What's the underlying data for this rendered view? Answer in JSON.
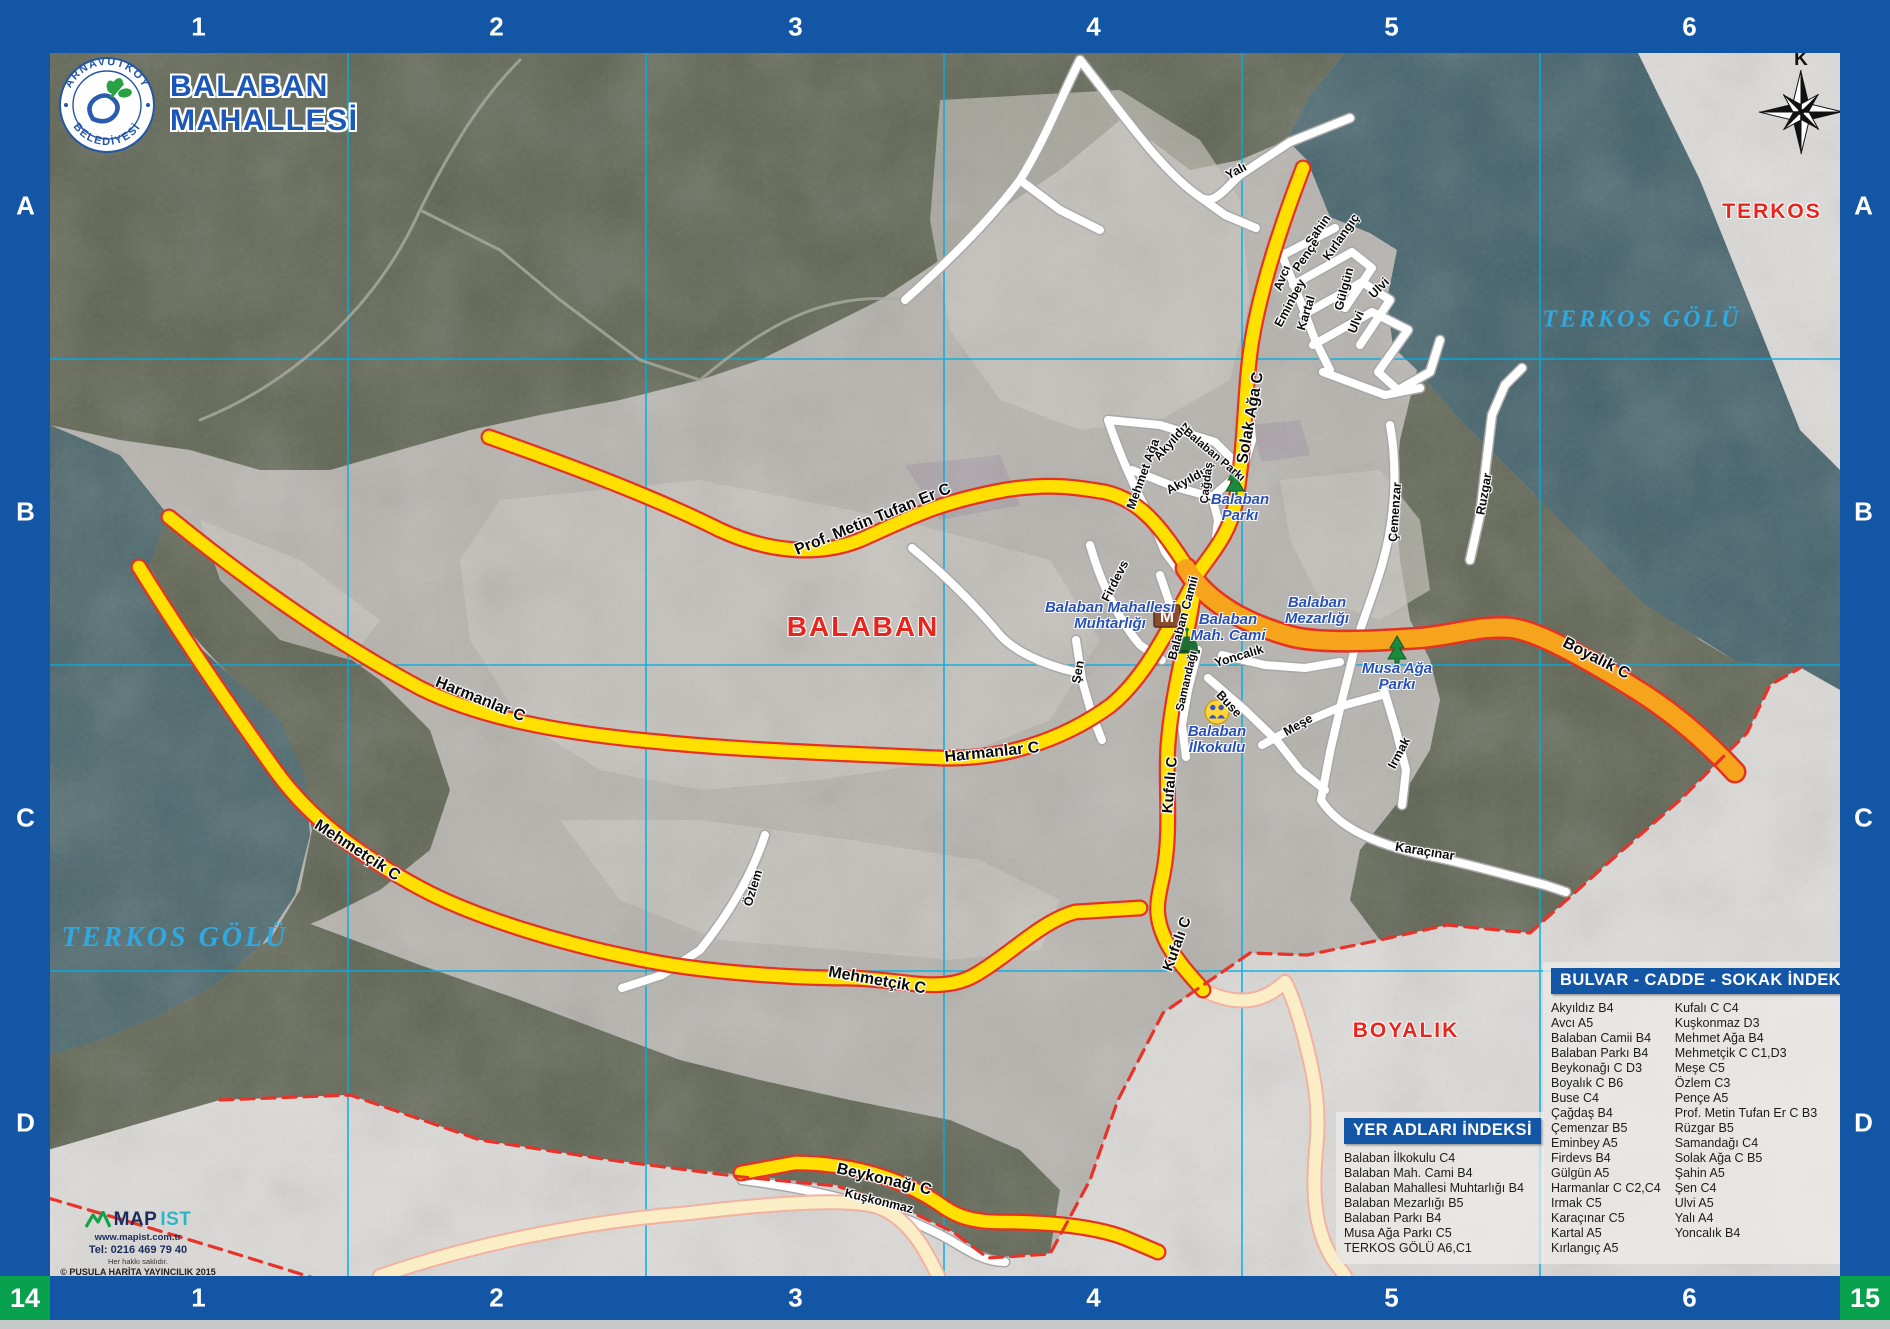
{
  "sheet": {
    "title_line1": "BALABAN",
    "title_line2": "MAHALLESİ",
    "logo_top": "ARNAVUTKÖY",
    "logo_bottom": "BELEDİYESİ",
    "compass_letter": "K"
  },
  "grid": {
    "columns": [
      "1",
      "2",
      "3",
      "4",
      "5",
      "6"
    ],
    "rows": [
      "A",
      "B",
      "C",
      "D"
    ],
    "corner_bottom_left": "14",
    "corner_bottom_right": "15"
  },
  "map": {
    "icons": {
      "muhtarlik_letter": "M"
    },
    "area_labels": [
      {
        "t": "BALABAN",
        "x": 863,
        "y": 627,
        "cls": "al-red",
        "s": 28
      },
      {
        "t": "TERKOS",
        "x": 1772,
        "y": 212,
        "cls": "al-red",
        "s": 21
      },
      {
        "t": "BOYALIK",
        "x": 1406,
        "y": 1031,
        "cls": "al-red",
        "s": 21
      },
      {
        "t": "TERKOS GÖLÜ",
        "x": 175,
        "y": 938,
        "cls": "al-lake",
        "s": 28
      },
      {
        "t": "TERKOS GÖLÜ",
        "x": 1642,
        "y": 320,
        "cls": "al-lake",
        "s": 24
      }
    ],
    "street_labels": [
      {
        "t": "Prof. Metin Tufan Er C",
        "x": 873,
        "y": 520,
        "r": -22,
        "s": 16
      },
      {
        "t": "Harmanlar C",
        "x": 480,
        "y": 700,
        "r": 22,
        "s": 16
      },
      {
        "t": "Harmanlar C",
        "x": 992,
        "y": 753,
        "r": -6,
        "s": 16
      },
      {
        "t": "Mehmetçik C",
        "x": 357,
        "y": 851,
        "r": 33,
        "s": 16
      },
      {
        "t": "Mehmetçik C",
        "x": 877,
        "y": 981,
        "r": 10,
        "s": 16
      },
      {
        "t": "Solak Ağa C",
        "x": 1251,
        "y": 418,
        "r": -80,
        "s": 16
      },
      {
        "t": "Kufalı C",
        "x": 1170,
        "y": 785,
        "r": -85,
        "s": 15
      },
      {
        "t": "Kufalı C",
        "x": 1177,
        "y": 944,
        "r": -70,
        "s": 15
      },
      {
        "t": "Boyalık C",
        "x": 1596,
        "y": 659,
        "r": 27,
        "s": 16
      },
      {
        "t": "Beykonağı C",
        "x": 884,
        "y": 1180,
        "r": 13,
        "s": 16
      },
      {
        "t": "Kuşkonmaz",
        "x": 879,
        "y": 1201,
        "r": 14,
        "s": 12.5
      },
      {
        "t": "Karaçınar",
        "x": 1425,
        "y": 851,
        "r": 9,
        "s": 13
      },
      {
        "t": "Yoncalık",
        "x": 1239,
        "y": 656,
        "r": -17,
        "s": 12.5
      },
      {
        "t": "Buse",
        "x": 1229,
        "y": 704,
        "r": 47,
        "s": 12.5
      },
      {
        "t": "Meşe",
        "x": 1298,
        "y": 725,
        "r": -30,
        "s": 12.5
      },
      {
        "t": "Samandağı",
        "x": 1187,
        "y": 681,
        "r": -77,
        "s": 11.5
      },
      {
        "t": "Şen",
        "x": 1078,
        "y": 672,
        "r": -80,
        "s": 12.5
      },
      {
        "t": "Firdevs",
        "x": 1115,
        "y": 581,
        "r": -63,
        "s": 12.5
      },
      {
        "t": "Balaban Camii",
        "x": 1183,
        "y": 618,
        "r": -75,
        "s": 12.5
      },
      {
        "t": "Mehmet Ağa",
        "x": 1143,
        "y": 474,
        "r": -70,
        "s": 12.5
      },
      {
        "t": "Akyıldız",
        "x": 1172,
        "y": 441,
        "r": -48,
        "s": 12.5
      },
      {
        "t": "Akyıldız",
        "x": 1188,
        "y": 480,
        "r": -28,
        "s": 12.5
      },
      {
        "t": "Balaban Parkı",
        "x": 1214,
        "y": 455,
        "r": 40,
        "s": 11.5
      },
      {
        "t": "Çağdaş",
        "x": 1207,
        "y": 483,
        "r": -83,
        "s": 11.5
      },
      {
        "t": "Çemenzar",
        "x": 1395,
        "y": 512,
        "r": -86,
        "s": 12.5
      },
      {
        "t": "Ruzgar",
        "x": 1484,
        "y": 494,
        "r": -80,
        "s": 12.5
      },
      {
        "t": "Irmak",
        "x": 1399,
        "y": 753,
        "r": -62,
        "s": 12.5
      },
      {
        "t": "Özlem",
        "x": 753,
        "y": 888,
        "r": -73,
        "s": 12.5
      },
      {
        "t": "Yalı",
        "x": 1236,
        "y": 171,
        "r": -28,
        "s": 12.5
      },
      {
        "t": "Avcı",
        "x": 1282,
        "y": 278,
        "r": -68,
        "s": 12.5
      },
      {
        "t": "Eminbey",
        "x": 1290,
        "y": 303,
        "r": -62,
        "s": 12.5
      },
      {
        "t": "Kartal",
        "x": 1306,
        "y": 313,
        "r": -73,
        "s": 12.5
      },
      {
        "t": "Şahin",
        "x": 1318,
        "y": 230,
        "r": -55,
        "s": 12.5
      },
      {
        "t": "Pençe",
        "x": 1306,
        "y": 255,
        "r": -55,
        "s": 12.5
      },
      {
        "t": "Kırlangıç",
        "x": 1341,
        "y": 237,
        "r": -55,
        "s": 12.5
      },
      {
        "t": "Gülgün",
        "x": 1344,
        "y": 289,
        "r": -75,
        "s": 12.5
      },
      {
        "t": "Ulvi",
        "x": 1356,
        "y": 322,
        "r": -68,
        "s": 12.5
      },
      {
        "t": "Ulvi",
        "x": 1379,
        "y": 288,
        "r": -45,
        "s": 12.5
      }
    ],
    "place_labels": [
      {
        "lines": [
          "Balaban Mahallesi",
          "Muhtarlığı"
        ],
        "x": 1110,
        "y": 616
      },
      {
        "lines": [
          "Balaban",
          "Mah. Cami"
        ],
        "x": 1228,
        "y": 628
      },
      {
        "lines": [
          "Balaban",
          "Mezarlığı"
        ],
        "x": 1317,
        "y": 611
      },
      {
        "lines": [
          "Balaban",
          "Parkı"
        ],
        "x": 1240,
        "y": 508
      },
      {
        "lines": [
          "Musa Ağa",
          "Parkı"
        ],
        "x": 1397,
        "y": 677
      },
      {
        "lines": [
          "Balaban",
          "İlkokulu"
        ],
        "x": 1217,
        "y": 740
      }
    ]
  },
  "street_index": {
    "title": "BULVAR - CADDE - SOKAK İNDEKSİ",
    "col1": [
      "Akyıldız B4",
      "Avcı A5",
      "Balaban Camii B4",
      "Balaban Parkı B4",
      "Beykonağı C D3",
      "Boyalık C B6",
      "Buse C4",
      "Çağdaş B4",
      "Çemenzar B5",
      "Eminbey A5",
      "Firdevs B4",
      "Gülgün A5",
      "Harmanlar C C2,C4",
      "Irmak C5",
      "Karaçınar C5",
      "Kartal A5",
      "Kırlangıç A5"
    ],
    "col2": [
      "Kufalı C C4",
      "Kuşkonmaz D3",
      "Mehmet Ağa B4",
      "Mehmetçik C C1,D3",
      "Meşe C5",
      "Özlem C3",
      "Pençe A5",
      "Prof. Metin Tufan Er C B3",
      "Rüzgar B5",
      "Samandağı C4",
      "Solak Ağa C B5",
      "Şahin A5",
      "Şen C4",
      "Ulvi A5",
      "Yalı A4",
      "Yoncalık B4"
    ]
  },
  "place_index": {
    "title": "YER ADLARI İNDEKSİ",
    "items": [
      "Balaban İlkokulu C4",
      "Balaban Mah. Cami B4",
      "Balaban Mahallesi Muhtarlığı B4",
      "Balaban Mezarlığı B5",
      "Balaban Parkı B4",
      "Musa Ağa Parkı C5",
      "TERKOS GÖLÜ A6,C1"
    ]
  },
  "publisher": {
    "brand_map": "MAP",
    "brand_ist": "IST",
    "url": "www.mapist.com.tr",
    "tel": "Tel: 0216 469 79 40",
    "rights": "Her hakkı saklıdır.",
    "copyright": "© PUSULA HARİTA YAYINCILIK 2015"
  },
  "colors": {
    "frame_blue": "#1456a6",
    "corner_green": "#08a24f",
    "grid_cyan": "#00aee4",
    "road_yellow": "#ffe000",
    "road_orange": "#f6a41c",
    "road_casing_red": "#e53224",
    "road_white": "#ffffff",
    "road_cream": "#fbeec6",
    "lake_teal": "#4a666b",
    "forest": "#5f6553",
    "field": "#b7b4af",
    "outside": "#dddbd8",
    "boundary_red": "#e8332a",
    "label_blue": "#2750b9",
    "label_red": "#e8251d",
    "lake_label_cyan": "#2fa9e0"
  }
}
